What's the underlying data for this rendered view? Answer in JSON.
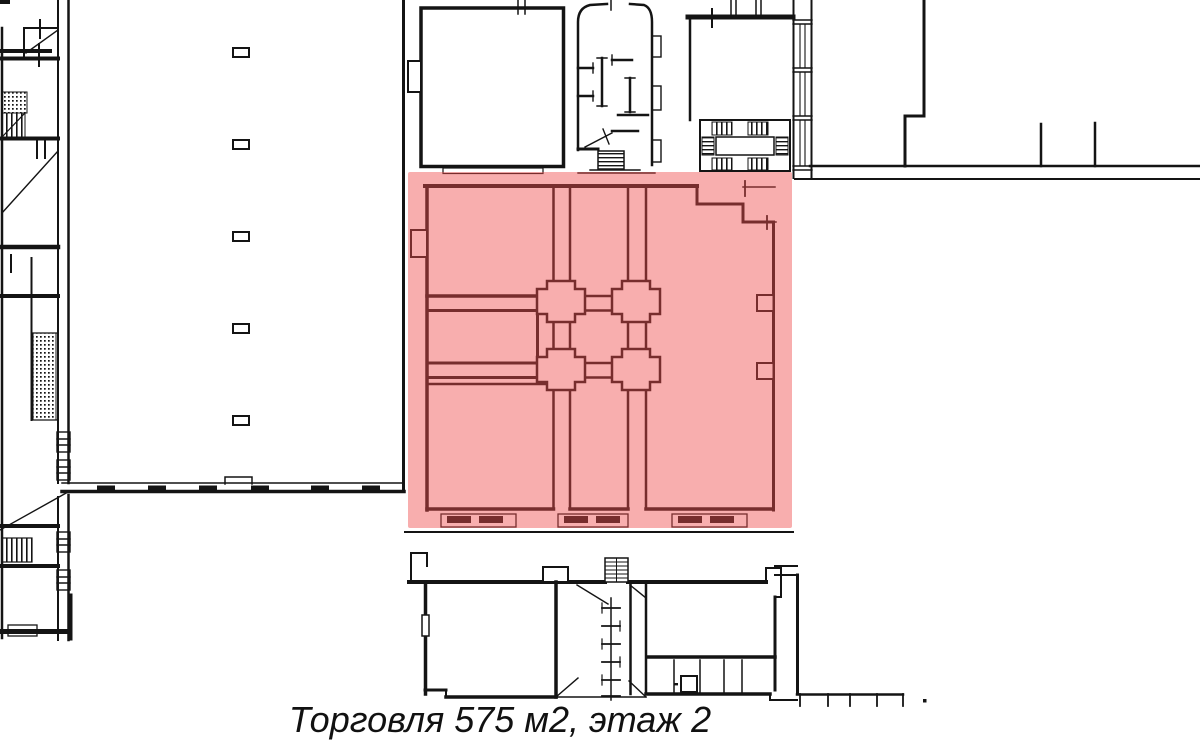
{
  "canvas": {
    "width": 1200,
    "height": 745,
    "background": "#ffffff",
    "line_color": "#141414"
  },
  "highlight": {
    "fill": "rgba(240,75,75,0.45)",
    "usage": "Торговля",
    "area": "575 м2",
    "floor": "этаж 2"
  },
  "caption": {
    "text": "Торговля 575 м2, этаж 2"
  }
}
